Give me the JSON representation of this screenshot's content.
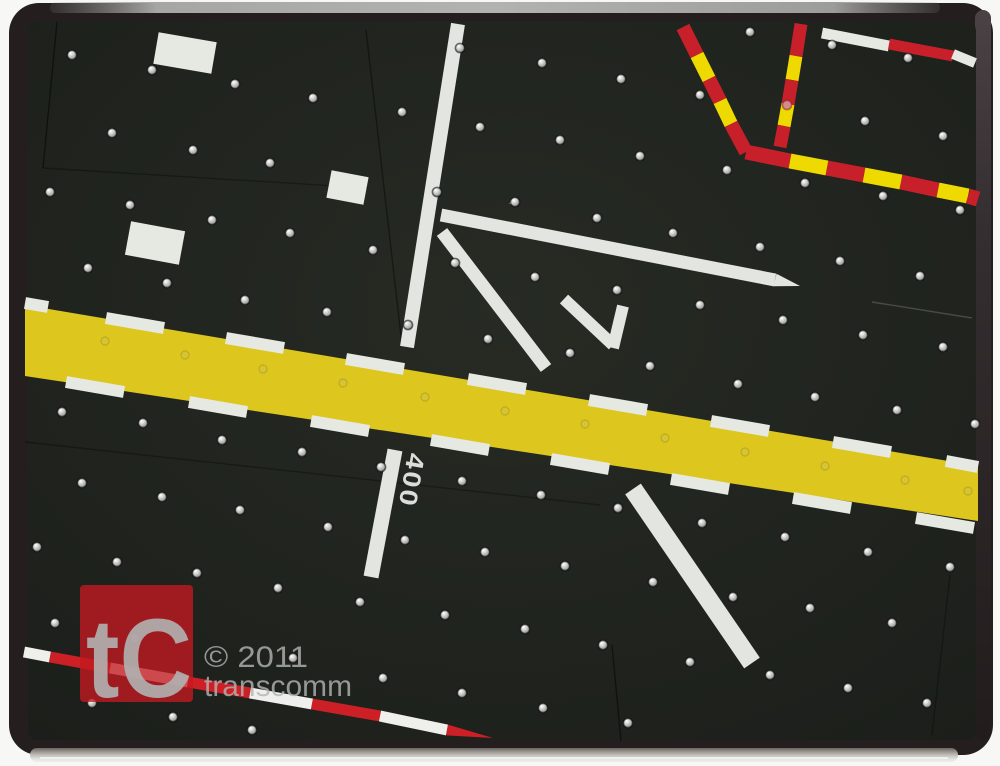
{
  "watermark": {
    "logo_text": "tC",
    "copyright": "© 2011",
    "brand": "transcomm",
    "logo_bg_color": "#c41a20",
    "text_color": "#b5b5b5",
    "glyph_color": "#b2b2b2"
  },
  "label_400": {
    "text": "400",
    "size": 25,
    "color": "#dcdcda"
  },
  "colors": {
    "frame": "#241e1f",
    "board": "#212420",
    "runway_yellow": "#ddc71f",
    "taxiway_white": "#e3e5e0",
    "dash_white": "#e6e8e2",
    "barrier_red": "#c8202a",
    "barrier_yellow": "#eed900",
    "pole_red": "#cc1f26",
    "pole_white": "#efefec"
  },
  "runway": {
    "color_key": "runway_yellow",
    "points": [
      [
        25,
        305
      ],
      [
        978,
        466
      ],
      [
        978,
        521
      ],
      [
        25,
        376
      ]
    ]
  },
  "bars": [
    {
      "p": [
        458,
        24,
        407,
        347
      ],
      "w": 14,
      "color": "taxiway_white",
      "name": "taxiway-line"
    },
    {
      "p": [
        441,
        215,
        775,
        280
      ],
      "w": 13,
      "color": "taxiway_white",
      "name": "taxiway-line"
    },
    {
      "p": [
        775,
        280,
        800,
        286
      ],
      "w": 13,
      "color": "taxiway_white",
      "name": "taxiway-line",
      "cap": "taper"
    },
    {
      "p": [
        442,
        232,
        546,
        368
      ],
      "w": 13,
      "color": "taxiway_white",
      "name": "taxiway-line"
    },
    {
      "p": [
        564,
        299,
        613,
        345
      ],
      "w": 12,
      "color": "taxiway_white",
      "name": "arrow-chevron-stroke"
    },
    {
      "p": [
        623,
        306,
        613,
        348
      ],
      "w": 12,
      "color": "taxiway_white",
      "name": "arrow-chevron-stroke"
    },
    {
      "p": [
        633,
        489,
        752,
        663
      ],
      "w": 19,
      "color": "taxiway_white",
      "name": "taxiway-line"
    },
    {
      "p": [
        395,
        450,
        371,
        577
      ],
      "w": 15,
      "color": "taxiway_white",
      "name": "taxiway-line"
    },
    {
      "p": [
        156,
        48,
        214,
        58
      ],
      "w": 32,
      "color": "dash_white",
      "name": "label-block"
    },
    {
      "p": [
        128,
        238,
        182,
        248
      ],
      "w": 34,
      "color": "dash_white",
      "name": "label-block"
    },
    {
      "p": [
        329,
        184,
        366,
        191
      ],
      "w": 28,
      "color": "dash_white",
      "name": "label-block"
    },
    {
      "p": [
        822,
        33,
        889,
        46
      ],
      "w": 11,
      "color": "dash_white",
      "name": "marking-bar"
    },
    {
      "p": [
        889,
        44,
        953,
        56
      ],
      "w": 11,
      "color": "barrier_red",
      "name": "marking-bar"
    },
    {
      "p": [
        953,
        54,
        975,
        63
      ],
      "w": 10,
      "color": "dash_white",
      "name": "marking-bar"
    },
    {
      "p": [
        683,
        27,
        697,
        55
      ],
      "w": 14,
      "color": "barrier_red",
      "name": "barrier-segment"
    },
    {
      "p": [
        697,
        55,
        709,
        79
      ],
      "w": 14,
      "color": "barrier_yellow",
      "name": "barrier-segment"
    },
    {
      "p": [
        709,
        79,
        720,
        101
      ],
      "w": 14,
      "color": "barrier_red",
      "name": "barrier-segment"
    },
    {
      "p": [
        720,
        101,
        731,
        124
      ],
      "w": 14,
      "color": "barrier_yellow",
      "name": "barrier-segment"
    },
    {
      "p": [
        731,
        124,
        746,
        152
      ],
      "w": 14,
      "color": "barrier_red",
      "name": "barrier-segment"
    },
    {
      "p": [
        801,
        24,
        796,
        56
      ],
      "w": 13,
      "color": "barrier_red",
      "name": "barrier-segment"
    },
    {
      "p": [
        796,
        56,
        792,
        80
      ],
      "w": 13,
      "color": "barrier_yellow",
      "name": "barrier-segment"
    },
    {
      "p": [
        792,
        80,
        788,
        104
      ],
      "w": 13,
      "color": "barrier_red",
      "name": "barrier-segment"
    },
    {
      "p": [
        788,
        104,
        784,
        126
      ],
      "w": 13,
      "color": "barrier_yellow",
      "name": "barrier-segment"
    },
    {
      "p": [
        784,
        126,
        780,
        147
      ],
      "w": 13,
      "color": "barrier_red",
      "name": "barrier-segment"
    },
    {
      "p": [
        746,
        152,
        790,
        161
      ],
      "w": 15,
      "color": "barrier_red",
      "name": "barrier-segment"
    },
    {
      "p": [
        790,
        161,
        827,
        168
      ],
      "w": 15,
      "color": "barrier_yellow",
      "name": "barrier-segment"
    },
    {
      "p": [
        827,
        168,
        864,
        175
      ],
      "w": 15,
      "color": "barrier_red",
      "name": "barrier-segment"
    },
    {
      "p": [
        864,
        175,
        901,
        182
      ],
      "w": 15,
      "color": "barrier_yellow",
      "name": "barrier-segment"
    },
    {
      "p": [
        901,
        182,
        938,
        190
      ],
      "w": 15,
      "color": "barrier_red",
      "name": "barrier-segment"
    },
    {
      "p": [
        938,
        190,
        968,
        196
      ],
      "w": 15,
      "color": "barrier_yellow",
      "name": "barrier-segment"
    },
    {
      "p": [
        968,
        196,
        978,
        199
      ],
      "w": 15,
      "color": "barrier_red",
      "name": "barrier-segment"
    },
    {
      "p": [
        25,
        303,
        48,
        307
      ],
      "w": 12,
      "color": "dash_white",
      "name": "runway-edge-dash"
    },
    {
      "p": [
        106,
        318,
        164,
        328
      ],
      "w": 12,
      "color": "dash_white",
      "name": "runway-edge-dash"
    },
    {
      "p": [
        226,
        338,
        284,
        348
      ],
      "w": 12,
      "color": "dash_white",
      "name": "runway-edge-dash"
    },
    {
      "p": [
        346,
        359,
        404,
        369
      ],
      "w": 12,
      "color": "dash_white",
      "name": "runway-edge-dash"
    },
    {
      "p": [
        468,
        379,
        526,
        389
      ],
      "w": 12,
      "color": "dash_white",
      "name": "runway-edge-dash"
    },
    {
      "p": [
        589,
        400,
        647,
        410
      ],
      "w": 12,
      "color": "dash_white",
      "name": "runway-edge-dash"
    },
    {
      "p": [
        711,
        421,
        769,
        431
      ],
      "w": 12,
      "color": "dash_white",
      "name": "runway-edge-dash"
    },
    {
      "p": [
        833,
        442,
        891,
        452
      ],
      "w": 12,
      "color": "dash_white",
      "name": "runway-edge-dash"
    },
    {
      "p": [
        946,
        461,
        978,
        467
      ],
      "w": 12,
      "color": "dash_white",
      "name": "runway-edge-dash"
    },
    {
      "p": [
        66,
        382,
        124,
        392
      ],
      "w": 12,
      "color": "dash_white",
      "name": "runway-edge-dash"
    },
    {
      "p": [
        189,
        402,
        247,
        412
      ],
      "w": 12,
      "color": "dash_white",
      "name": "runway-edge-dash"
    },
    {
      "p": [
        311,
        421,
        369,
        431
      ],
      "w": 12,
      "color": "dash_white",
      "name": "runway-edge-dash"
    },
    {
      "p": [
        431,
        440,
        489,
        450
      ],
      "w": 12,
      "color": "dash_white",
      "name": "runway-edge-dash"
    },
    {
      "p": [
        551,
        459,
        609,
        469
      ],
      "w": 12,
      "color": "dash_white",
      "name": "runway-edge-dash"
    },
    {
      "p": [
        671,
        479,
        729,
        489
      ],
      "w": 12,
      "color": "dash_white",
      "name": "runway-edge-dash"
    },
    {
      "p": [
        793,
        498,
        851,
        508
      ],
      "w": 12,
      "color": "dash_white",
      "name": "runway-edge-dash"
    },
    {
      "p": [
        916,
        518,
        974,
        528
      ],
      "w": 12,
      "color": "dash_white",
      "name": "runway-edge-dash"
    },
    {
      "p": [
        24,
        652,
        50,
        657
      ],
      "w": 11,
      "color": "pole_white",
      "name": "stop-pole-segment"
    },
    {
      "p": [
        50,
        657,
        110,
        668
      ],
      "w": 11,
      "color": "pole_red",
      "name": "stop-pole-segment"
    },
    {
      "p": [
        110,
        668,
        188,
        682
      ],
      "w": 11,
      "color": "pole_white",
      "name": "stop-pole-segment"
    },
    {
      "p": [
        188,
        682,
        250,
        693
      ],
      "w": 11,
      "color": "pole_red",
      "name": "stop-pole-segment"
    },
    {
      "p": [
        250,
        693,
        312,
        704
      ],
      "w": 11,
      "color": "pole_white",
      "name": "stop-pole-segment"
    },
    {
      "p": [
        312,
        704,
        380,
        716
      ],
      "w": 11,
      "color": "pole_red",
      "name": "stop-pole-segment"
    },
    {
      "p": [
        380,
        716,
        447,
        730
      ],
      "w": 11,
      "color": "pole_white",
      "name": "stop-pole-segment"
    },
    {
      "p": [
        447,
        730,
        493,
        738
      ],
      "w": 11,
      "color": "pole_red",
      "name": "stop-pole-segment",
      "cap": "taper"
    },
    {
      "p": [
        510,
        202,
        517,
        204
      ],
      "w": 4,
      "color": "dash_white",
      "name": "dust-speck"
    }
  ],
  "seams": [
    {
      "p": [
        57,
        22,
        43,
        168
      ],
      "o": 0.45
    },
    {
      "p": [
        43,
        168,
        368,
        188
      ],
      "o": 0.3
    },
    {
      "p": [
        366,
        30,
        402,
        345
      ],
      "o": 0.4
    },
    {
      "p": [
        25,
        442,
        600,
        505
      ],
      "o": 0.3
    },
    {
      "p": [
        612,
        645,
        621,
        741
      ],
      "o": 0.45
    },
    {
      "p": [
        950,
        575,
        932,
        735
      ],
      "o": 0.28
    },
    {
      "p": [
        872,
        302,
        972,
        318
      ],
      "o": 0.22,
      "light": true
    }
  ],
  "dots": {
    "r": 4.6,
    "normal": [
      [
        750,
        32
      ],
      [
        832,
        45
      ],
      [
        908,
        58
      ],
      [
        460,
        48
      ],
      [
        542,
        63
      ],
      [
        621,
        79
      ],
      [
        700,
        95
      ],
      [
        865,
        121
      ],
      [
        943,
        136
      ],
      [
        72,
        55
      ],
      [
        152,
        70
      ],
      [
        235,
        84
      ],
      [
        313,
        98
      ],
      [
        402,
        112
      ],
      [
        480,
        127
      ],
      [
        560,
        140
      ],
      [
        640,
        156
      ],
      [
        727,
        170
      ],
      [
        805,
        183
      ],
      [
        883,
        196
      ],
      [
        960,
        210
      ],
      [
        112,
        133
      ],
      [
        193,
        150
      ],
      [
        270,
        163
      ],
      [
        437,
        192
      ],
      [
        515,
        202
      ],
      [
        597,
        218
      ],
      [
        673,
        233
      ],
      [
        760,
        247
      ],
      [
        840,
        261
      ],
      [
        920,
        276
      ],
      [
        50,
        192
      ],
      [
        130,
        205
      ],
      [
        212,
        220
      ],
      [
        290,
        233
      ],
      [
        373,
        250
      ],
      [
        455,
        263
      ],
      [
        535,
        277
      ],
      [
        617,
        290
      ],
      [
        700,
        305
      ],
      [
        783,
        320
      ],
      [
        863,
        335
      ],
      [
        943,
        347
      ],
      [
        88,
        268
      ],
      [
        167,
        283
      ],
      [
        245,
        300
      ],
      [
        327,
        312
      ],
      [
        408,
        325
      ],
      [
        488,
        339
      ],
      [
        570,
        353
      ],
      [
        650,
        366
      ],
      [
        738,
        384
      ],
      [
        815,
        397
      ],
      [
        897,
        410
      ],
      [
        975,
        424
      ],
      [
        62,
        412
      ],
      [
        143,
        423
      ],
      [
        222,
        440
      ],
      [
        302,
        452
      ],
      [
        381,
        467
      ],
      [
        462,
        481
      ],
      [
        541,
        495
      ],
      [
        618,
        508
      ],
      [
        702,
        523
      ],
      [
        785,
        537
      ],
      [
        868,
        552
      ],
      [
        950,
        567
      ],
      [
        82,
        483
      ],
      [
        162,
        497
      ],
      [
        240,
        510
      ],
      [
        328,
        527
      ],
      [
        405,
        540
      ],
      [
        485,
        552
      ],
      [
        565,
        566
      ],
      [
        653,
        582
      ],
      [
        733,
        597
      ],
      [
        810,
        608
      ],
      [
        892,
        623
      ],
      [
        37,
        547
      ],
      [
        117,
        562
      ],
      [
        197,
        573
      ],
      [
        278,
        588
      ],
      [
        360,
        602
      ],
      [
        445,
        615
      ],
      [
        525,
        629
      ],
      [
        603,
        645
      ],
      [
        690,
        662
      ],
      [
        770,
        675
      ],
      [
        848,
        688
      ],
      [
        927,
        703
      ],
      [
        55,
        623
      ],
      [
        135,
        638
      ],
      [
        293,
        658
      ],
      [
        383,
        678
      ],
      [
        462,
        693
      ],
      [
        543,
        708
      ],
      [
        628,
        723
      ],
      [
        92,
        703
      ],
      [
        173,
        717
      ],
      [
        252,
        730
      ]
    ],
    "in_band": [
      [
        105,
        341
      ],
      [
        185,
        355
      ],
      [
        263,
        369
      ],
      [
        343,
        383
      ],
      [
        425,
        397
      ],
      [
        505,
        411
      ],
      [
        585,
        424
      ],
      [
        665,
        438
      ],
      [
        745,
        452
      ],
      [
        825,
        466
      ],
      [
        905,
        480
      ],
      [
        968,
        491
      ]
    ],
    "red_tinted": [
      [
        787,
        105
      ]
    ]
  }
}
